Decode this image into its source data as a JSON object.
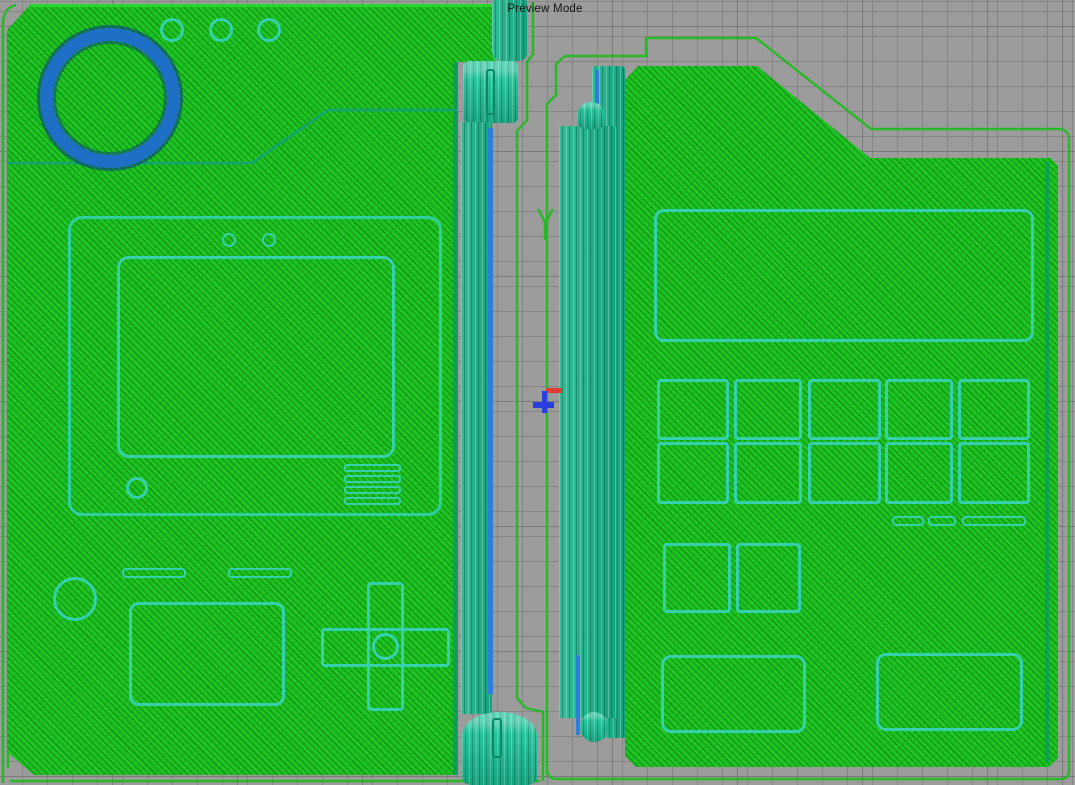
{
  "viewport": {
    "mode_label": "Preview Mode"
  },
  "scene": {
    "objects": [
      {
        "name": "pokedex-front-shell"
      },
      {
        "name": "pokedex-back-shell"
      }
    ],
    "front_shell": {
      "lens_ring_count": 1,
      "indicator_dot_count": 3,
      "speaker_slot_count": 4,
      "has_screen_window": true,
      "has_dpad": true
    },
    "back_shell": {
      "keypad_rows": 2,
      "keypad_cols": 5,
      "slot_count": 3,
      "bottom_panel_count": 2
    }
  },
  "colors": {
    "bed_gray": "#9c9c9c",
    "grid_minor": "#8f8f8f",
    "grid_major": "#7e7e7e",
    "shell_green": "#1dc522",
    "detail_teal": "#35d1ad",
    "hinge_teal": "#14b389",
    "skirt_green": "#27b827",
    "lens_blue": "#1e6fc6",
    "edge_blue": "#2e7ed8",
    "origin_marker_red": "#e03b30",
    "origin_marker_blue": "#2b3fe0"
  }
}
